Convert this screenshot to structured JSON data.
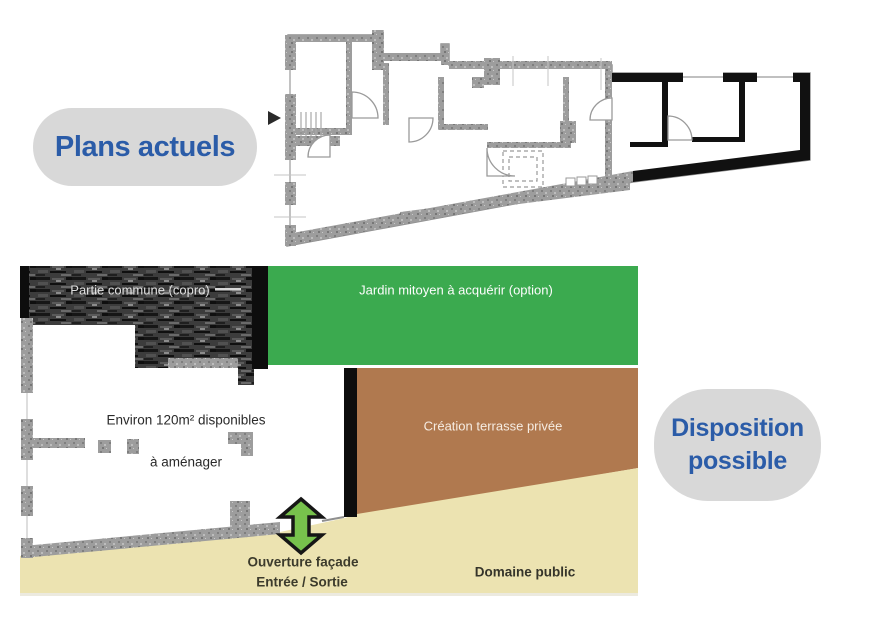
{
  "badges": {
    "plans_actuels": {
      "label": "Plans actuels"
    },
    "disposition": {
      "line1": "Disposition",
      "line2": "possible"
    },
    "bg": "#d8d8d8",
    "text_color": "#2b5ca8"
  },
  "diagram": {
    "partie_commune": {
      "label": "Partie commune (copro)"
    },
    "jardin": {
      "label": "Jardin mitoyen à acquérir (option)"
    },
    "surface": {
      "line1": "Environ 120m² disponibles",
      "line2": "à aménager"
    },
    "terrasse": {
      "label": "Création terrasse privée"
    },
    "ouverture": {
      "line1": "Ouverture façade",
      "line2": "Entrée / Sortie"
    },
    "domaine": {
      "label": "Domaine public"
    },
    "colors": {
      "garden_green": "#3baa4f",
      "terrace_brown": "#b0794f",
      "public_beige": "#ece3b1",
      "arrow_green": "#77c24c",
      "hatch_dark": "#2f2f2f",
      "wall_gray": "#9d9d9d",
      "wall_black": "#111111"
    }
  }
}
